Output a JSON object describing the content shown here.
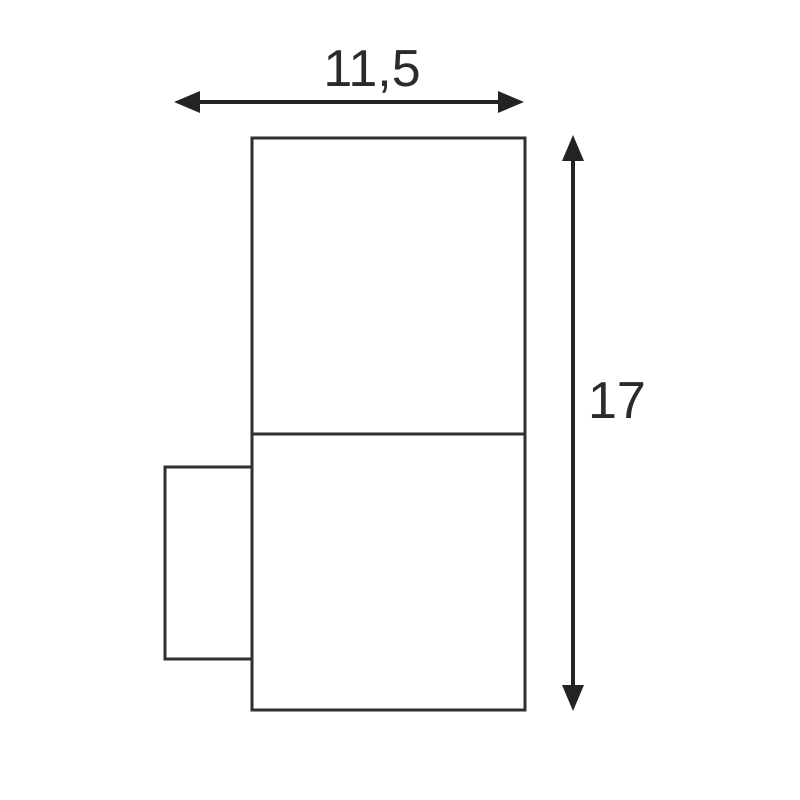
{
  "diagram": {
    "type": "technical-dimension-drawing",
    "subject": "wall luminaire side profile with dimension arrows",
    "colors": {
      "background": "#ffffff",
      "outline": "#2f2f2f",
      "dimension": "#232323",
      "text": "#2b2b2b"
    },
    "width_dimension": {
      "label": "11,5"
    },
    "height_dimension": {
      "label": "17"
    }
  }
}
